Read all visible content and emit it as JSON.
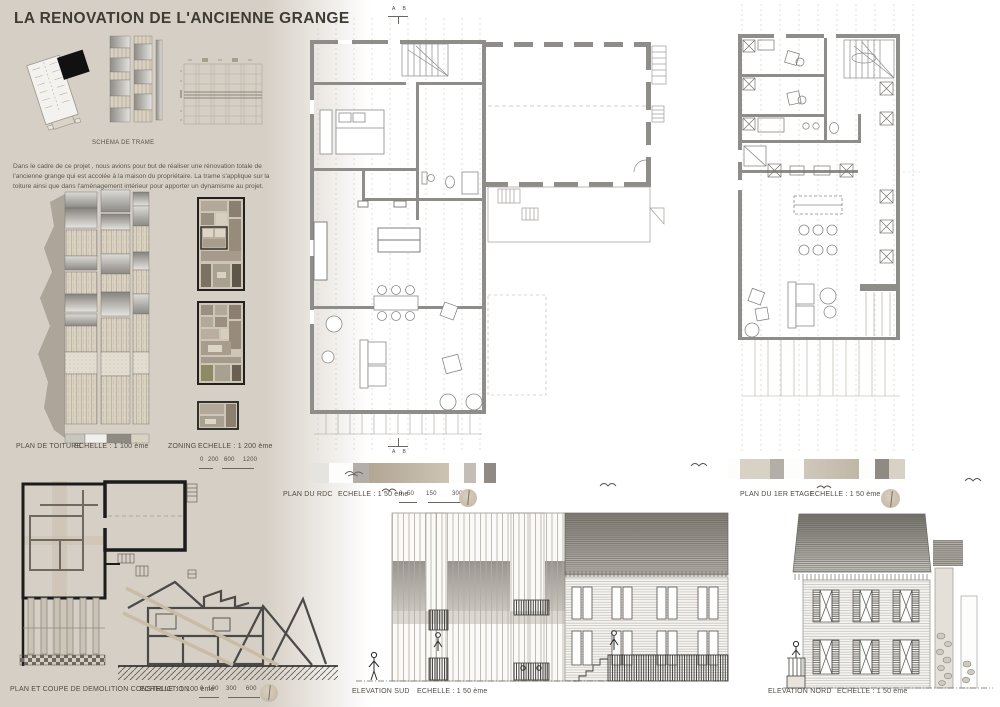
{
  "title": "LA RENOVATION DE L'ANCIENNE GRANGE",
  "intro": {
    "schema_label": "SCHEMA DE TRAME",
    "paragraph": "Dans le cadre de ce projet , nous avions pour but de réaliser une rénovation totale de l'ancienne grange qui est accolée à la maison du propriétaire. La trame s'applique sur la toiture ainsi que dans l'aménagement intérieur pour apporter un dynamisme au projet."
  },
  "markers": {
    "section_top": "A B",
    "section_bottom": "A B"
  },
  "panels": {
    "toiture": {
      "label": "PLAN DE TOITURE",
      "scale": "ECHELLE : 1 100 ème"
    },
    "zoning": {
      "label": "ZONING",
      "scale": "ECHELLE : 1 200 ème",
      "ticks": [
        "0",
        "200",
        "600",
        "1200"
      ]
    },
    "rdc": {
      "label": "PLAN DU RDC",
      "scale": "ECHELLE : 1 50 ème",
      "ticks": [
        "0",
        "50",
        "150",
        "300"
      ]
    },
    "etage": {
      "label": "PLAN DU 1ER ETAGE",
      "scale": "ECHELLE : 1 50 ème"
    },
    "demolition": {
      "label": "PLAN ET COUPE DE DEMOLITION CONSTRUCTION",
      "scale": "ECHELLE : 1 100 ème",
      "ticks": [
        "0",
        "100",
        "300",
        "600"
      ]
    },
    "elevation_sud": {
      "label": "ELEVATION SUD",
      "scale": "ECHELLE : 1 50 ème"
    },
    "elevation_nord": {
      "label": "ELEVATION NORD",
      "scale": "ECHELLE : 1 50 ème"
    }
  },
  "colors": {
    "background_beige": "#d6cfc5",
    "ink": "#3e3a34",
    "wall_gray": "#8f8d89",
    "accent_black": "#1c1c1c"
  }
}
